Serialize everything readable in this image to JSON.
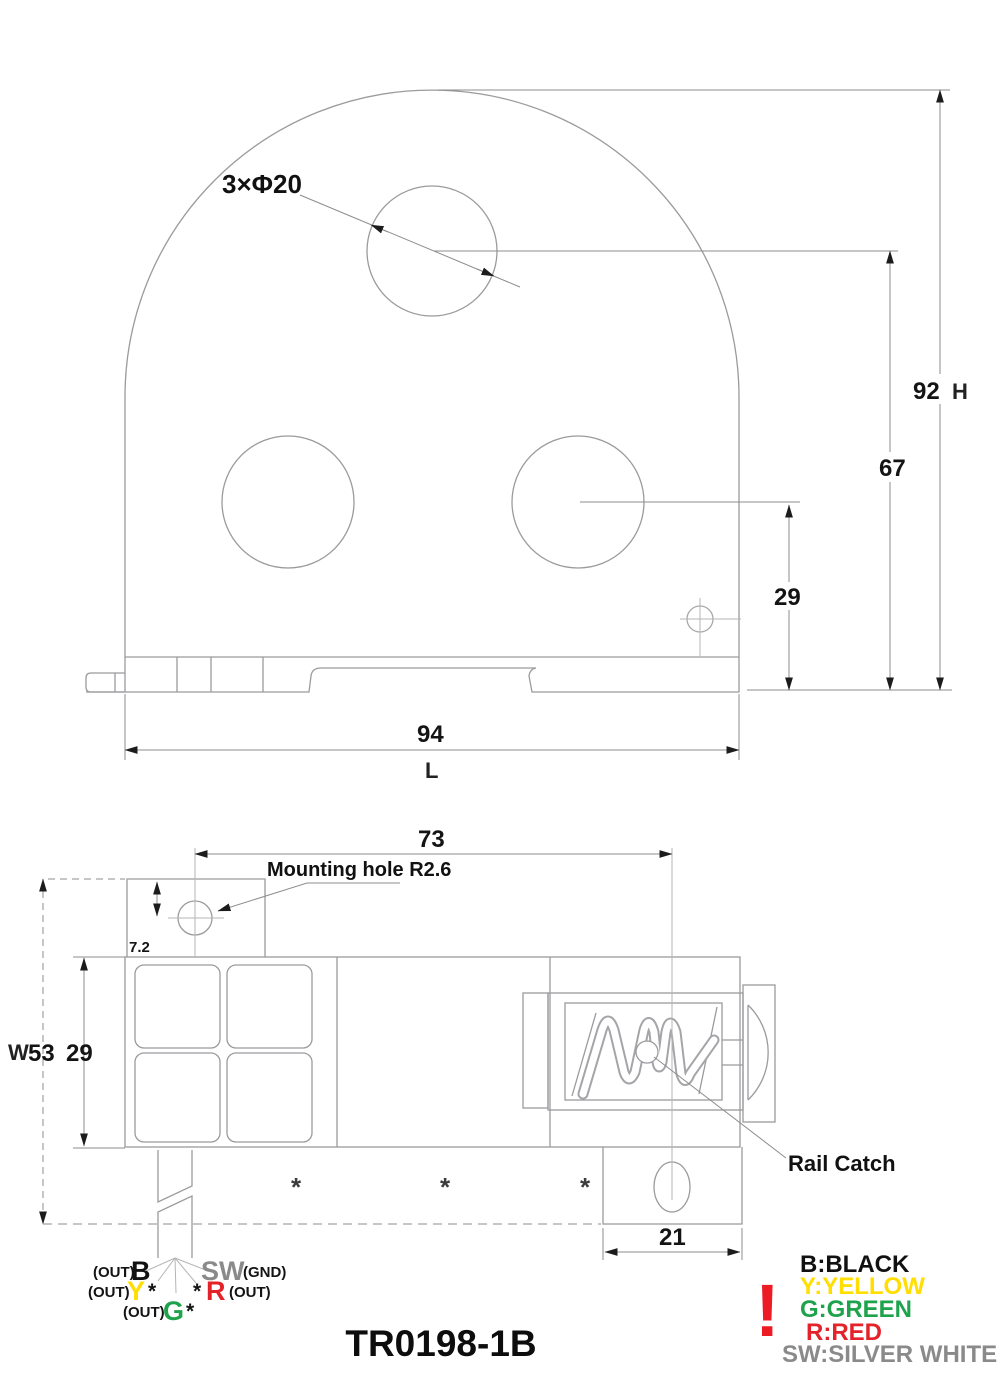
{
  "drawing": {
    "part_number": "TR0198-1B",
    "top_view": {
      "holes_label": "3×Φ20",
      "dim_height": "92",
      "dim_height_suffix": "H",
      "dim_top_hole": "67",
      "dim_side_hole": "29",
      "dim_length": "94",
      "dim_length_suffix": "L"
    },
    "side_view": {
      "dim_hole_to_catch": "73",
      "dim_hole_offset": "7.2",
      "mounting_hole_label": "Mounting hole R2.6",
      "dim_width_prefix": "W",
      "dim_width": "53",
      "dim_body": "29",
      "dim_catch": "21",
      "rail_catch_label": "Rail Catch",
      "asterisk": "*"
    },
    "wires": {
      "out_label": "(OUT)",
      "gnd_label": "(GND)",
      "star": "*",
      "b_code": "B",
      "y_code": "Y",
      "g_code": "G",
      "r_code": "R",
      "sw_code": "SW"
    },
    "wire_colors": {
      "b": "#111111",
      "y": "#FFDE00",
      "g": "#1FA24C",
      "r": "#E42229",
      "sw": "#8A8A8A"
    },
    "legend": {
      "warning_mark": "!",
      "warning_color": "#ED1C24",
      "items": [
        {
          "text": "B:BLACK",
          "color": "#111111"
        },
        {
          "text": "Y:YELLOW",
          "color": "#FFDE00"
        },
        {
          "text": "G:GREEN",
          "color": "#1FA24C"
        },
        {
          "text": "R:RED",
          "color": "#E42229"
        },
        {
          "text": "SW:SILVER WHITE",
          "color": "#8A8A8A"
        }
      ]
    }
  }
}
